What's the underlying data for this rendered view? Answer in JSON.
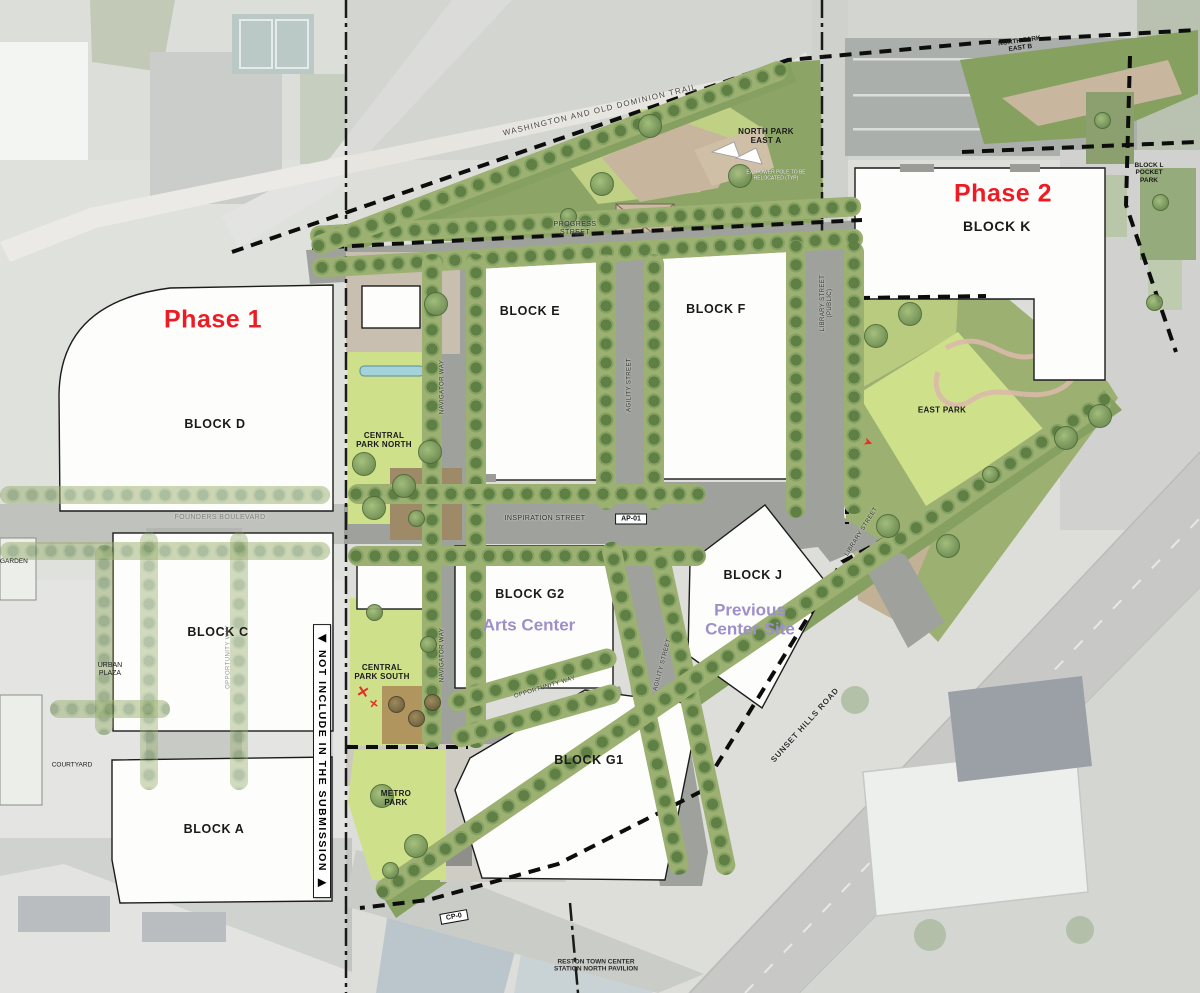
{
  "phases": {
    "phase1": "Phase 1",
    "phase2": "Phase 2"
  },
  "blocks": {
    "a": "BLOCK A",
    "c": "BLOCK C",
    "d": "BLOCK D",
    "e": "BLOCK E",
    "f": "BLOCK F",
    "g1": "BLOCK G1",
    "g2": "BLOCK G2",
    "j": "BLOCK J",
    "k": "BLOCK K"
  },
  "subtitles": {
    "g2": "Arts Center",
    "j": "Previous Center Site"
  },
  "parks": {
    "central_north": "CENTRAL PARK NORTH",
    "central_south": "CENTRAL PARK SOUTH",
    "metro": "METRO PARK",
    "east": "EAST PARK",
    "npe_a": "NORTH PARK EAST A",
    "npe_b": "NORTH PARK EAST B",
    "pocket": "BLOCK L POCKET PARK"
  },
  "streets": {
    "progress": "PROGRESS STREET",
    "inspiration": "INSPIRATION STREET",
    "founders": "FOUNDERS BOULEVARD",
    "navigator": "NAVIGATOR WAY",
    "agility": "AGILITY STREET",
    "library_public": "LIBRARY STREET (PUBLIC)",
    "library": "LIBRARY STREET",
    "opportunity": "OPPORTUNITY WAY",
    "sunset": "SUNSET HILLS ROAD",
    "wod_trail": "WASHINGTON AND OLD DOMINION TRAIL"
  },
  "places": {
    "urban_plaza": "URBAN PLAZA",
    "courtyard": "COURTYARD",
    "garden": "GARDEN",
    "station": "RESTON TOWN CENTER STATION NORTH PAVILION"
  },
  "badges": {
    "ap01": "AP-01",
    "cp0": "CP-0"
  },
  "banner": {
    "not_included": "◀ NOT INCLUDE IN THE SUBMISSION ▶"
  },
  "notes": {
    "power_pole": "EX. POWER POLE TO BE RELOCATED (TYP)"
  },
  "markers": {
    "red_x": "✕",
    "red_x2": "✕",
    "red_arrow": "➤"
  },
  "colors": {
    "phase_red": "#ed1c24",
    "subtitle_purple": "#9d8fc9",
    "park_lawn_green": "#cfe08b",
    "park_green": "#9cb071",
    "street_gray": "#9fa29c",
    "building_white": "#fdfdfc",
    "boundary_black": "#0d0d0d"
  }
}
